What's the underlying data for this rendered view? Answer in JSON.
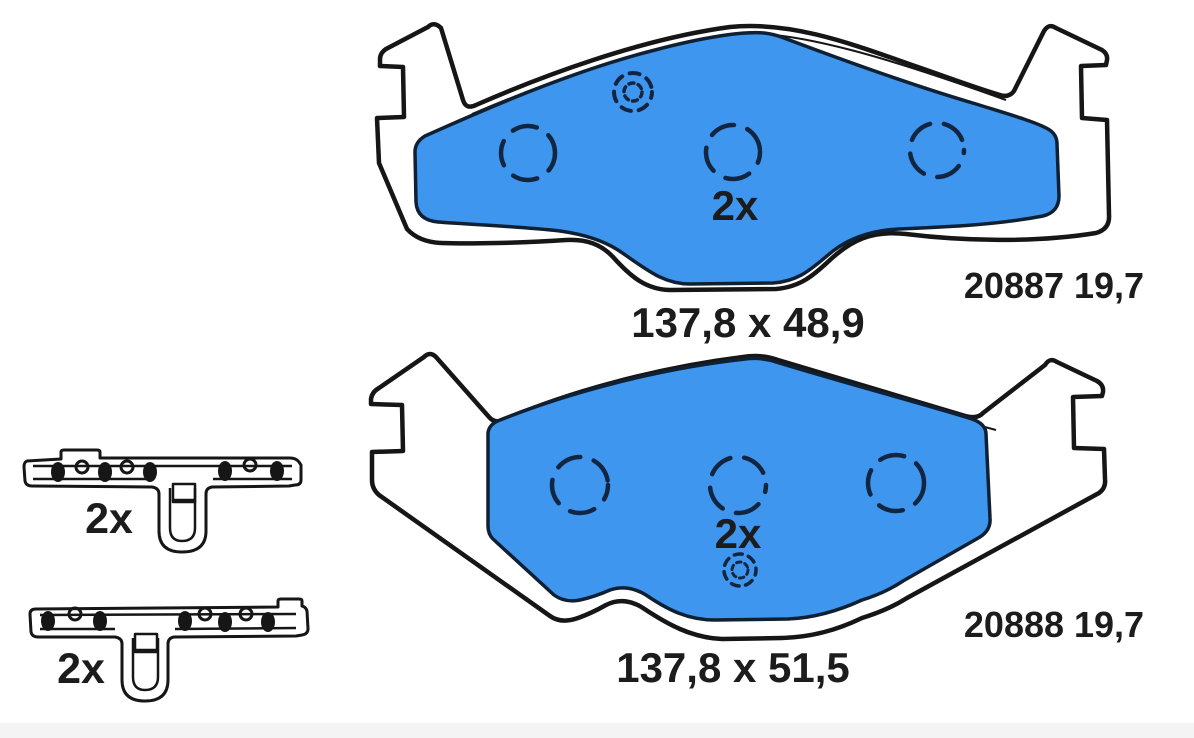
{
  "colors": {
    "background": "#ffffff",
    "outline": "#161616",
    "friction_blue": "#3e96ef",
    "friction_edge": "#0f2033",
    "marker_navy": "#132641",
    "text": "#1c1c1c",
    "strip": "#f4f4f4"
  },
  "parts": {
    "pad_top": {
      "quantity": "2x",
      "dimensions": "137,8 x 48,9",
      "part_code": "20887 19,7"
    },
    "pad_bottom": {
      "quantity": "2x",
      "dimensions": "137,8 x 51,5",
      "part_code": "20888 19,7"
    },
    "clip_top": {
      "quantity": "2x"
    },
    "clip_bottom": {
      "quantity": "2x"
    }
  },
  "icons": {
    "wear_indicator": "dashed-concentric-circles",
    "mounting_hole": "dashed-circle",
    "rivet": "filled-oval",
    "rivet_hole": "small-ring"
  }
}
